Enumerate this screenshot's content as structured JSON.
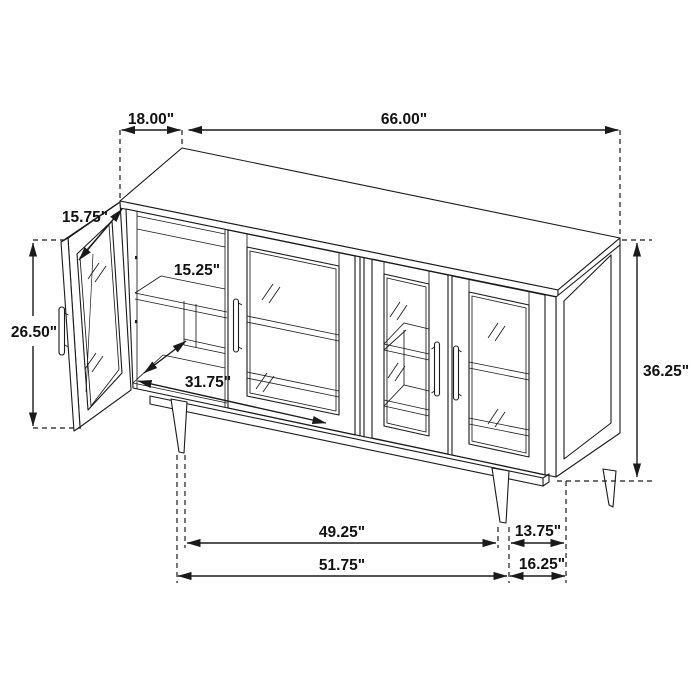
{
  "diagram": {
    "type": "furniture-dimension-drawing",
    "subject": "sideboard-with-glass-doors",
    "units": "inches"
  },
  "colors": {
    "line": "#1a1a1a",
    "background": "#ffffff"
  },
  "dims": {
    "top_depth": {
      "label": "18.00\""
    },
    "top_width": {
      "label": "66.00\""
    },
    "door_width": {
      "label": "15.75\""
    },
    "shelf_depth": {
      "label": "15.25\""
    },
    "door_height": {
      "label": "26.50\""
    },
    "interior_width": {
      "label": "31.75\""
    },
    "overall_height": {
      "label": "36.25\""
    },
    "leg_span_inner": {
      "label": "49.25\""
    },
    "leg_inset_right": {
      "label": "13.75\""
    },
    "leg_span_outer": {
      "label": "51.75\""
    },
    "corner_offset_right": {
      "label": "16.25\""
    }
  }
}
